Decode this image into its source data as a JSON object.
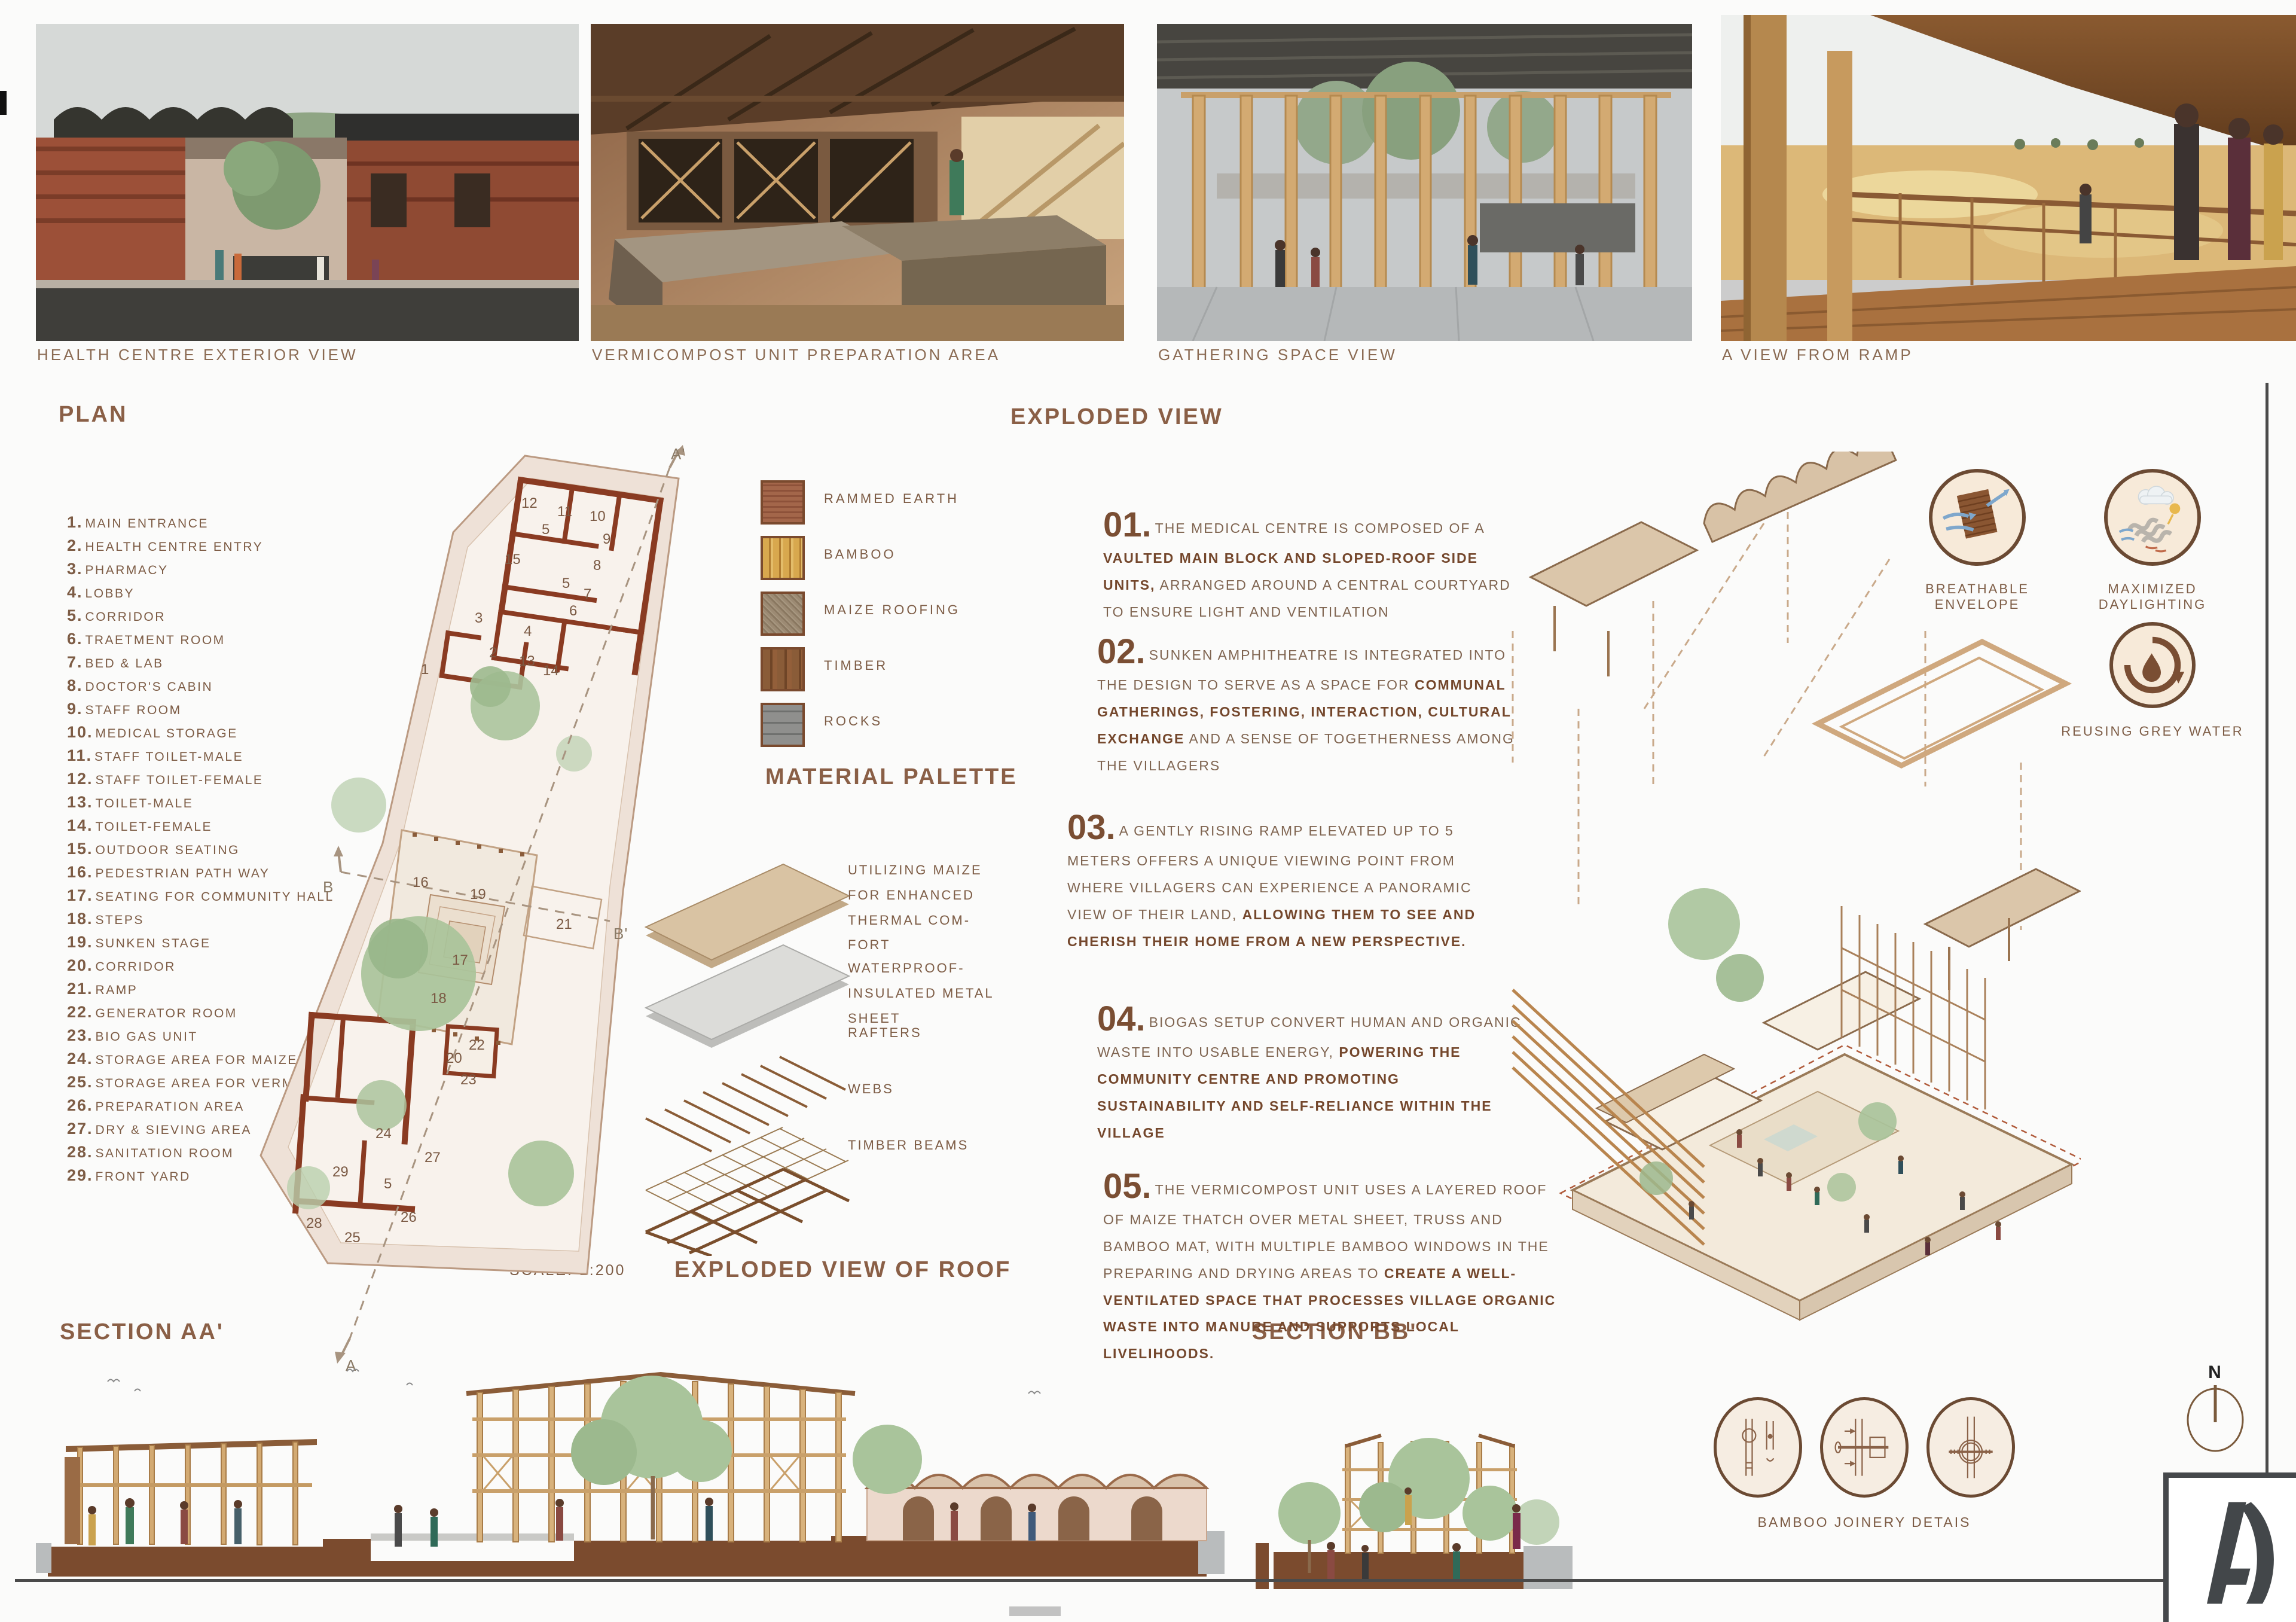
{
  "colors": {
    "accent_brown": "#7a4e33",
    "heading_brown": "#8a5f46",
    "wall_red": "#8a3b22",
    "tan": "#d8c2a6",
    "text_brown": "#7d5c45"
  },
  "sheet": {
    "number_label": "SHEET NO : 02",
    "watermark": "archi_QJ0ToAzvpbEpx7"
  },
  "photos": [
    {
      "caption": "HEALTH CENTRE EXTERIOR VIEW"
    },
    {
      "caption": "VERMICOMPOST UNIT PREPARATION AREA"
    },
    {
      "caption": "GATHERING SPACE VIEW"
    },
    {
      "caption": "A VIEW FROM RAMP"
    }
  ],
  "plan": {
    "title": "PLAN",
    "scale_label": "SCALE: 1:200",
    "markers": {
      "a_top": "A'",
      "a_bottom": "A",
      "b_left": "B",
      "b_right": "B'"
    },
    "legend": [
      {
        "num": "1.",
        "label": "MAIN ENTRANCE"
      },
      {
        "num": "2.",
        "label": "HEALTH CENTRE ENTRY"
      },
      {
        "num": "3.",
        "label": "PHARMACY"
      },
      {
        "num": "4.",
        "label": "LOBBY"
      },
      {
        "num": "5.",
        "label": "CORRIDOR"
      },
      {
        "num": "6.",
        "label": "TRAETMENT ROOM"
      },
      {
        "num": "7.",
        "label": "BED & LAB"
      },
      {
        "num": "8.",
        "label": "DOCTOR'S CABIN"
      },
      {
        "num": "9.",
        "label": "STAFF ROOM"
      },
      {
        "num": "10.",
        "label": "MEDICAL STORAGE"
      },
      {
        "num": "11.",
        "label": "STAFF TOILET-MALE"
      },
      {
        "num": "12.",
        "label": "STAFF TOILET-FEMALE"
      },
      {
        "num": "13.",
        "label": "TOILET-MALE"
      },
      {
        "num": "14.",
        "label": "TOILET-FEMALE"
      },
      {
        "num": "15.",
        "label": "OUTDOOR SEATING"
      },
      {
        "num": "16.",
        "label": "PEDESTRIAN PATH WAY"
      },
      {
        "num": "17.",
        "label": "SEATING FOR COMMUNITY HALL"
      },
      {
        "num": "18.",
        "label": "STEPS"
      },
      {
        "num": "19.",
        "label": "SUNKEN STAGE"
      },
      {
        "num": "20.",
        "label": "CORRIDOR"
      },
      {
        "num": "21.",
        "label": "RAMP"
      },
      {
        "num": "22.",
        "label": "GENERATOR ROOM"
      },
      {
        "num": "23.",
        "label": "BIO GAS UNIT"
      },
      {
        "num": "24.",
        "label": "STORAGE AREA FOR MAIZE"
      },
      {
        "num": "25.",
        "label": "STORAGE AREA FOR VERMICOMPOST"
      },
      {
        "num": "26.",
        "label": "PREPARATION AREA"
      },
      {
        "num": "27.",
        "label": "DRY & SIEVING AREA"
      },
      {
        "num": "28.",
        "label": "SANITATION ROOM"
      },
      {
        "num": "29.",
        "label": "FRONT YARD"
      }
    ],
    "room_numbers": [
      {
        "n": "12",
        "style": "left:452px;top:88px"
      },
      {
        "n": "11",
        "style": "left:512px;top:102px"
      },
      {
        "n": "10",
        "style": "left:566px;top:110px"
      },
      {
        "n": "5",
        "style": "left:486px;top:132px"
      },
      {
        "n": "9",
        "style": "left:588px;top:148px"
      },
      {
        "n": "15",
        "style": "left:424px;top:182px"
      },
      {
        "n": "8",
        "style": "left:572px;top:192px"
      },
      {
        "n": "5",
        "style": "left:520px;top:222px"
      },
      {
        "n": "7",
        "style": "left:556px;top:240px"
      },
      {
        "n": "6",
        "style": "left:532px;top:268px"
      },
      {
        "n": "3",
        "style": "left:374px;top:280px"
      },
      {
        "n": "4",
        "style": "left:456px;top:302px"
      },
      {
        "n": "2",
        "style": "left:398px;top:338px"
      },
      {
        "n": "13",
        "style": "left:448px;top:352px"
      },
      {
        "n": "14",
        "style": "left:488px;top:368px"
      },
      {
        "n": "1",
        "style": "left:284px;top:366px"
      },
      {
        "n": "16",
        "style": "left:270px;top:722px"
      },
      {
        "n": "19",
        "style": "left:366px;top:742px"
      },
      {
        "n": "21",
        "style": "left:510px;top:792px"
      },
      {
        "n": "17",
        "style": "left:336px;top:852px"
      },
      {
        "n": "18",
        "style": "left:300px;top:916px"
      },
      {
        "n": "22",
        "style": "left:364px;top:994px"
      },
      {
        "n": "20",
        "style": "left:326px;top:1016px"
      },
      {
        "n": "23",
        "style": "left:350px;top:1052px"
      },
      {
        "n": "24",
        "style": "left:208px;top:1142px"
      },
      {
        "n": "27",
        "style": "left:290px;top:1182px"
      },
      {
        "n": "29",
        "style": "left:136px;top:1206px"
      },
      {
        "n": "5",
        "style": "left:222px;top:1226px"
      },
      {
        "n": "26",
        "style": "left:250px;top:1282px"
      },
      {
        "n": "28",
        "style": "left:92px;top:1292px"
      },
      {
        "n": "25",
        "style": "left:156px;top:1316px"
      }
    ]
  },
  "materials": {
    "title": "MATERIAL PALETTE",
    "items": [
      {
        "name": "RAMMED EARTH",
        "swatch_class": "sw sw-earth"
      },
      {
        "name": "BAMBOO",
        "swatch_class": "sw sw-bamboo"
      },
      {
        "name": "MAIZE ROOFING",
        "swatch_class": "sw sw-maize"
      },
      {
        "name": "TIMBER",
        "swatch_class": "sw sw-timber"
      },
      {
        "name": "ROCKS",
        "swatch_class": "sw sw-rocks"
      }
    ]
  },
  "roof_exploded": {
    "title": "EXPLODED VIEW OF ROOF",
    "labels": [
      {
        "text": "UTILIZING MAIZE FOR ENHANCED THERMAL COM- FORT",
        "style": "left:18px;top:24px;width:250px"
      },
      {
        "text": "WATERPROOF-INSULATED METAL SHEET",
        "style": "left:18px;top:188px;width:330px"
      },
      {
        "text": "RAFTERS",
        "style": "left:18px;top:296px;width:300px"
      },
      {
        "text": "WEBS",
        "style": "left:18px;top:390px;width:300px"
      },
      {
        "text": "TIMBER BEAMS",
        "style": "left:18px;top:484px;width:320px"
      }
    ]
  },
  "exploded_view": {
    "title": "EXPLODED VIEW",
    "notes": [
      {
        "num": "01.",
        "style": "left:10px;top:14px;width:700px",
        "segments": [
          {
            "t": "THE MEDICAL CENTRE IS COMPOSED OF A ",
            "b": false
          },
          {
            "t": "VAULTED MAIN BLOCK AND SLOPED-ROOF SIDE UNITS,",
            "b": true
          },
          {
            "t": " ARRANGED AROUND A CENTRAL COURTYARD TO ENSURE LIGHT AND VENTILATION",
            "b": false
          }
        ]
      },
      {
        "num": "02.",
        "style": "left:0px;top:226px;width:700px",
        "segments": [
          {
            "t": "SUNKEN AMPHITHEATRE IS INTEGRATED INTO THE DESIGN TO SERVE AS A SPACE FOR ",
            "b": false
          },
          {
            "t": "COMMUNAL GATHERINGS, FOSTERING, INTERACTION, CULTURAL EXCHANGE",
            "b": true
          },
          {
            "t": " AND A SENSE OF TOGETHERNESS AMONG THE VILLAGERS",
            "b": false
          }
        ]
      },
      {
        "num": "03.",
        "style": "left:-50px;top:520px;width:740px",
        "segments": [
          {
            "t": "A GENTLY RISING RAMP ELEVATED UP TO 5 METERS OFFERS A UNIQUE VIEWING POINT FROM WHERE VILLAGERS CAN EXPERIENCE A PANORAMIC VIEW OF THEIR LAND, ",
            "b": false
          },
          {
            "t": "ALLOWING THEM TO SEE AND CHERISH THEIR HOME FROM A NEW PERSPECTIVE.",
            "b": true
          }
        ]
      },
      {
        "num": "04.",
        "style": "left:0px;top:840px;width:720px",
        "segments": [
          {
            "t": "BIOGAS SETUP CONVERT HUMAN AND ORGANIC WASTE INTO USABLE ENERGY, ",
            "b": false
          },
          {
            "t": "POWERING THE COMMUNITY CENTRE AND PROMOTING SUSTAINABILITY AND SELF-RELIANCE WITHIN THE VILLAGE",
            "b": true
          }
        ]
      },
      {
        "num": "05.",
        "style": "left:10px;top:1120px;width:780px",
        "segments": [
          {
            "t": "THE VERMICOMPOST UNIT USES A LAYERED ROOF OF MAIZE THATCH OVER METAL SHEET, TRUSS AND BAMBOO MAT, WITH MULTIPLE BAMBOO WINDOWS IN THE PREPARING AND DRYING AREAS TO ",
            "b": false
          },
          {
            "t": "CREATE A WELL-VENTILATED SPACE THAT PROCESSES VILLAGE ORGANIC WASTE INTO MANURE AND SUPPORTS LOCAL LIVELIHOODS.",
            "b": true
          }
        ]
      }
    ]
  },
  "features": [
    {
      "label": "BREATHABLE ENVELOPE"
    },
    {
      "label": "MAXIMIZED DAYLIGHTING"
    },
    {
      "label": "REUSING GREY WATER"
    }
  ],
  "sections": {
    "aa_title": "SECTION AA'",
    "bb_title": "SECTION BB'"
  },
  "details": {
    "label": "BAMBOO JOINERY DETAIS"
  },
  "compass": {
    "label": "N"
  },
  "logo": {
    "letter": "A"
  }
}
